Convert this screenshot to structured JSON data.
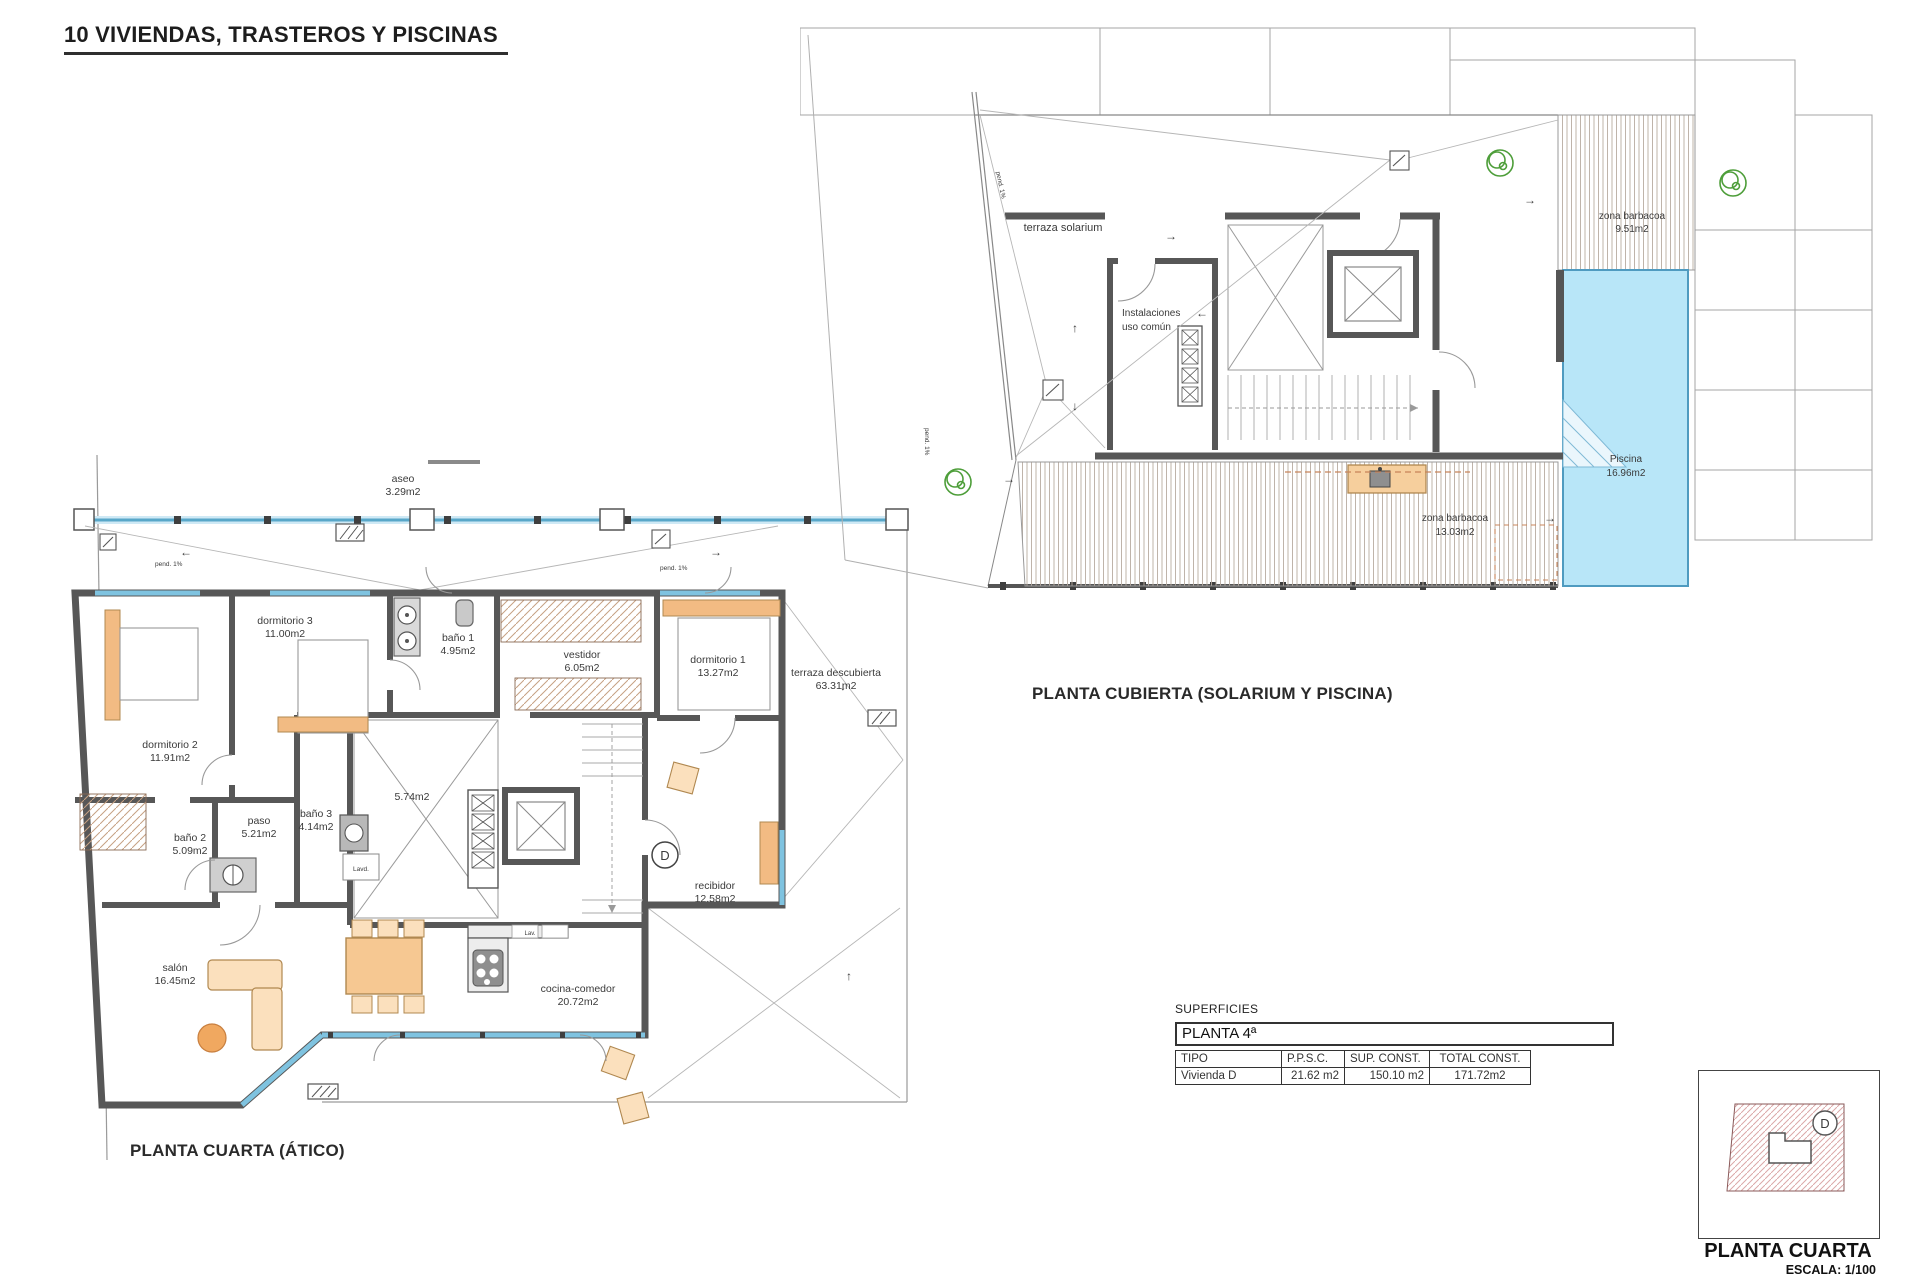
{
  "title": "10 VIVIENDAS, TRASTEROS Y PISCINAS",
  "annotations": {
    "slope": "pend. 1%"
  },
  "plan_left": {
    "caption": "PLANTA CUARTA (ÁTICO)",
    "unit_letter": "D",
    "rooms": {
      "aseo": {
        "name": "aseo",
        "area": "3.29m2"
      },
      "dormitorio3": {
        "name": "dormitorio 3",
        "area": "11.00m2"
      },
      "bano1": {
        "name": "baño 1",
        "area": "4.95m2"
      },
      "vestidor": {
        "name": "vestidor",
        "area": "6.05m2"
      },
      "dormitorio1": {
        "name": "dormitorio 1",
        "area": "13.27m2"
      },
      "terraza": {
        "name": "terraza descubierta",
        "area": "63.31m2"
      },
      "dormitorio2": {
        "name": "dormitorio 2",
        "area": "11.91m2"
      },
      "paso": {
        "name": "paso",
        "area": "5.21m2"
      },
      "bano3": {
        "name": "baño 3",
        "area": "4.14m2"
      },
      "bano2": {
        "name": "baño 2",
        "area": "5.09m2"
      },
      "patio": {
        "area": "5.74m2"
      },
      "recibidor": {
        "name": "recibidor",
        "area": "12.58m2"
      },
      "salon": {
        "name": "salón",
        "area": "16.45m2"
      },
      "cocina": {
        "name": "cocina-comedor",
        "area": "20.72m2"
      },
      "lavadero": {
        "name": "Lavd."
      },
      "lav": {
        "name": "Lav."
      }
    }
  },
  "plan_right": {
    "caption": "PLANTA CUBIERTA (SOLARIUM Y PISCINA)",
    "labels": {
      "terraza_solarium": "terraza solarium",
      "instalaciones_1": "Instalaciones",
      "instalaciones_2": "uso común",
      "barbacoa_top": {
        "name": "zona barbacoa",
        "area": "9.51m2"
      },
      "piscina": {
        "name": "Piscina",
        "area": "16.96m2"
      },
      "barbacoa_bottom": {
        "name": "zona barbacoa",
        "area": "13.03m2"
      }
    }
  },
  "surface_table": {
    "section_label": "SUPERFICIES",
    "floor_label": "PLANTA 4ª",
    "headers": [
      "TIPO",
      "P.P.S.C.",
      "SUP. CONST.",
      "TOTAL CONST."
    ],
    "rows": [
      [
        "Vivienda D",
        "21.62 m2",
        "150.10 m2",
        "171.72m2"
      ]
    ]
  },
  "keyplan": {
    "caption": "PLANTA CUARTA",
    "scale": "ESCALA: 1/100",
    "unit_letter": "D"
  }
}
